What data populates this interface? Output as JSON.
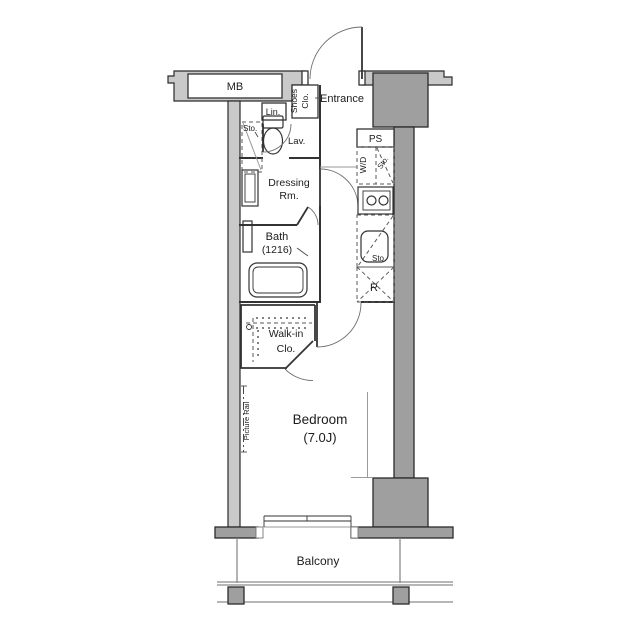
{
  "colors": {
    "background": "#ffffff",
    "wall_light": "#c9c9c9",
    "wall_dark": "#9f9f9f",
    "wall_outline": "#2b2b2b",
    "line": "#333333",
    "line_thin": "#8c8c8c",
    "text": "#1c1c1c"
  },
  "labels": {
    "meter_box": "MB",
    "entrance": "Entrance",
    "shoes_closet": [
      "Shoes",
      "Clo."
    ],
    "linen": "Lin.",
    "storage_lavatory": "Sto.",
    "lavatory": "Lav.",
    "dressing_room": [
      "Dressing",
      "Rm."
    ],
    "pipe_space": "PS",
    "washer_dryer": "W/D",
    "storage_washer": "Sto.",
    "bath": [
      "Bath",
      "(1216)"
    ],
    "storage_kitchen": "Sto.",
    "refrigerator": "R",
    "walk_in_closet": [
      "Walk-in",
      "Clo."
    ],
    "picture_rail": "Picture Rail",
    "bedroom": [
      "Bedroom",
      "(7.0J)"
    ],
    "balcony": "Balcony"
  }
}
